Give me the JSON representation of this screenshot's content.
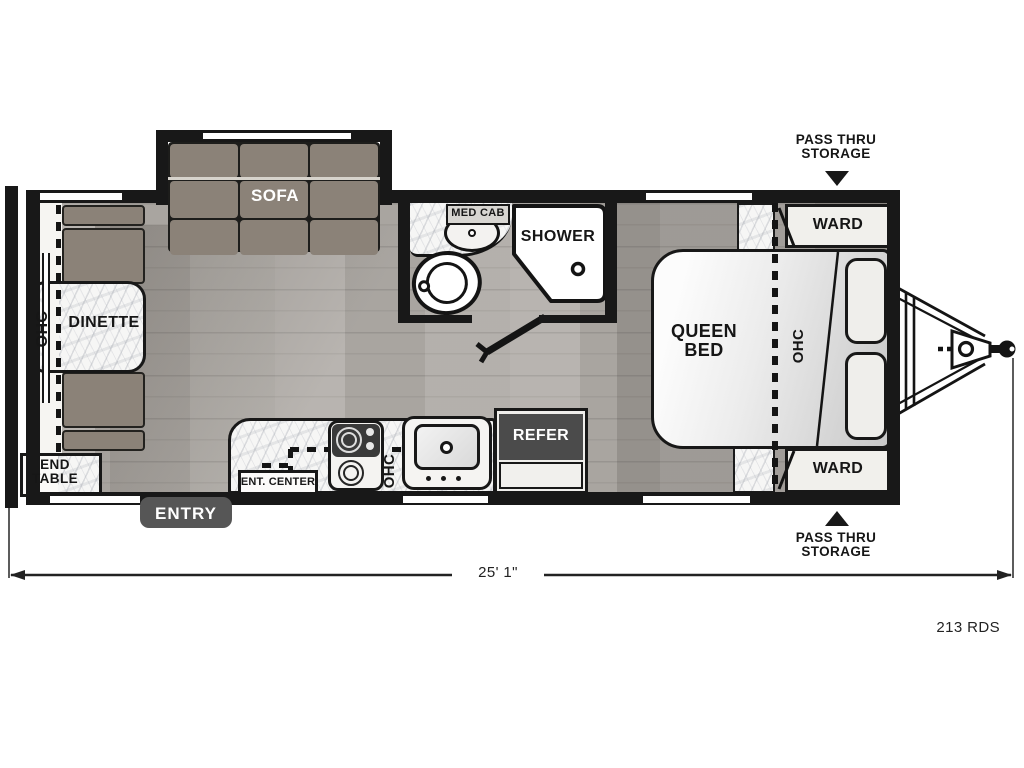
{
  "model_code": "213 RDS",
  "dimension": {
    "length": "25' 1\""
  },
  "exterior": {
    "pass_thru_top": "PASS THRU STORAGE",
    "pass_thru_bottom": "PASS THRU STORAGE",
    "entry": "ENTRY"
  },
  "living": {
    "sofa": "SOFA",
    "dinette": "DINETTE",
    "dinette_ohc": "OHC",
    "end_table": "END TABLE"
  },
  "kitchen": {
    "ent_center": "ENT. CENTER",
    "ohc": "OHC",
    "refer": "REFER"
  },
  "bath": {
    "med_cab": "MED CAB",
    "shower": "SHOWER"
  },
  "bedroom": {
    "queen_bed": "QUEEN BED",
    "ohc": "OHC",
    "ward_top": "WARD",
    "ward_bottom": "WARD"
  },
  "colors": {
    "wall": "#181818",
    "cushion": "#8b8278",
    "floor": "#b2aea9",
    "dark_label_box": "#4b4b4b"
  }
}
